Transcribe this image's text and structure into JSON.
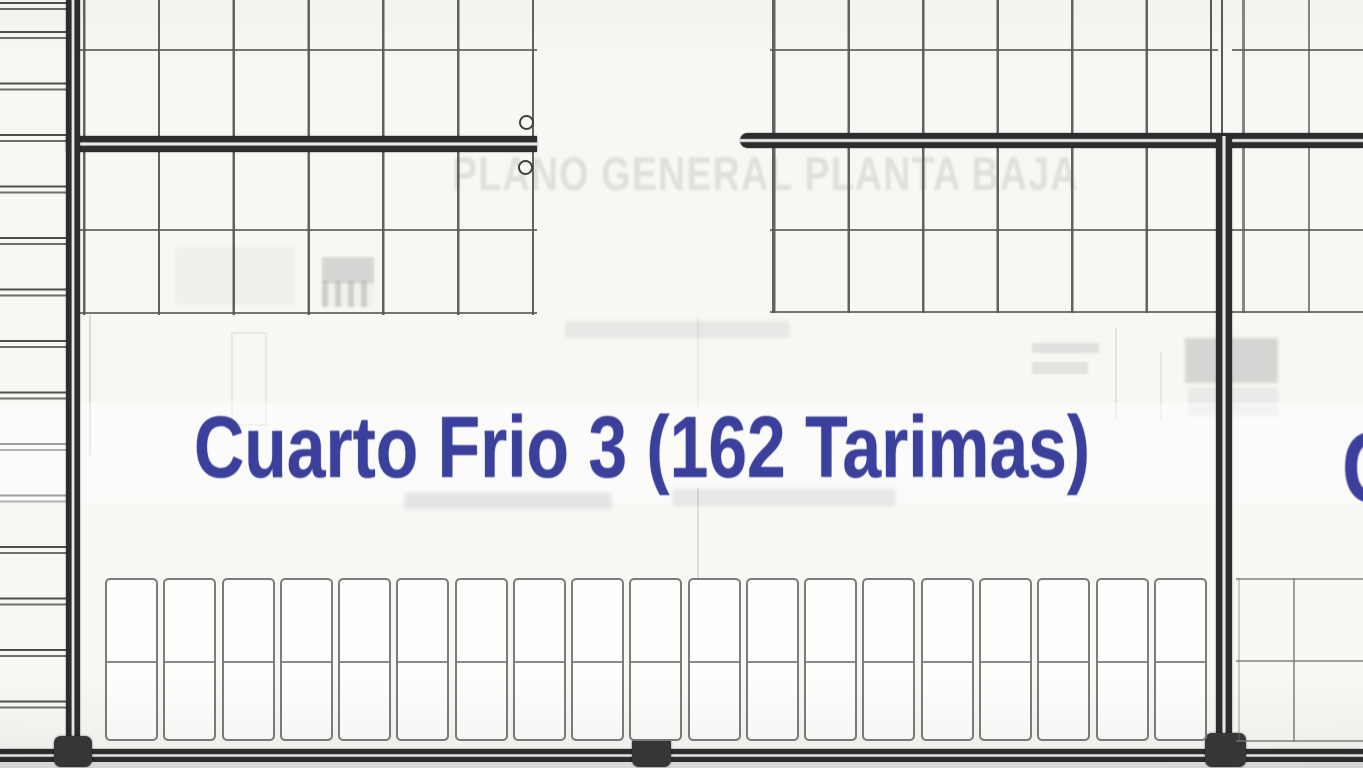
{
  "plan": {
    "room_label": "Cuarto Frio 3 (162 Tarimas)",
    "ghost_title": "PLANO GENERAL PLANTA BAJA",
    "adjacent_room_partial_label": "C",
    "colors": {
      "label_blue": "#3a409c",
      "wall_dark": "#2d2d2d",
      "grid_line": "#707070",
      "background": "#f7f7f4"
    }
  },
  "racks": {
    "bottom_row_left_cells": 19,
    "bottom_row_right_cells": 3
  }
}
